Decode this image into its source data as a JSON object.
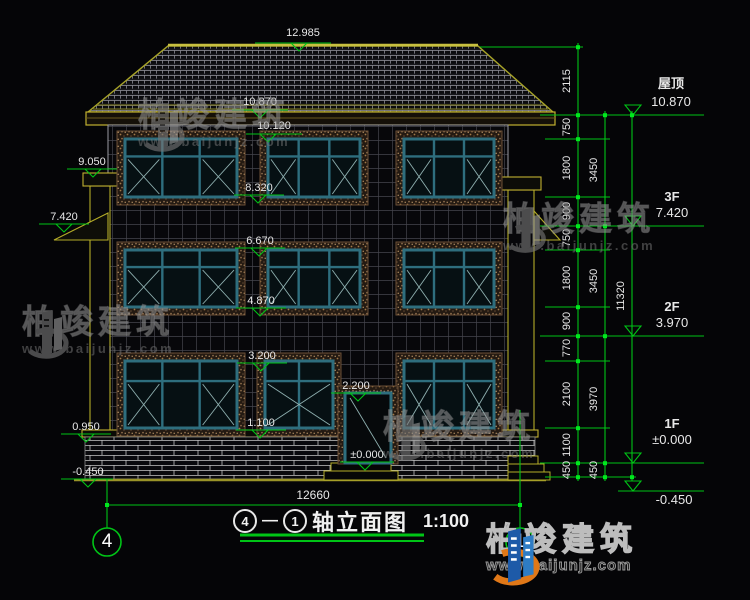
{
  "drawing": {
    "title": {
      "axis_start": "4",
      "axis_end": "1",
      "dash": "—",
      "name": "轴立面图",
      "scale": "1:100"
    },
    "bottom_dimension": "12660",
    "axis_bubbles": [
      "4",
      "1"
    ],
    "middle_markers": [
      "12.985",
      "10.870",
      "10.120",
      "8.320",
      "6.670",
      "4.870",
      "3.200",
      "2.200",
      "1.100",
      "±0.000"
    ],
    "left_markers": [
      "9.050",
      "7.420",
      "0.950",
      "-0.450"
    ],
    "right_levels": [
      {
        "label": "屋顶",
        "value": "10.870"
      },
      {
        "label": "3F",
        "value": "7.420"
      },
      {
        "label": "2F",
        "value": "3.970"
      },
      {
        "label": "1F",
        "value": "±0.000"
      },
      {
        "label": "",
        "value": "-0.450"
      }
    ],
    "dim_chain_inner": [
      "2115",
      "750",
      "1800",
      "900",
      "750",
      "1800",
      "900",
      "770",
      "2100",
      "1100",
      "450"
    ],
    "dim_chain_mid": [
      "3450",
      "3450",
      "3970",
      "450"
    ],
    "dim_chain_outer": [
      "11320"
    ]
  },
  "watermark": {
    "brand": "柏竣建筑",
    "url": "www.baijunjz.com",
    "icon": "building-swoosh-icon"
  },
  "logo": {
    "brand": "柏竣建筑",
    "url": "www.baijunjz.com",
    "icon": "building-swoosh-icon"
  },
  "colors": {
    "background": "#050507",
    "dimension_green": "#00c416",
    "outline_yellow": "#b4ac28",
    "window_teal": "#2e6e7e",
    "trim_tan": "#7a5c42",
    "text_white": "#e8e8e8",
    "logo_blue": "#1d5aa8",
    "logo_orange": "#e07818"
  }
}
